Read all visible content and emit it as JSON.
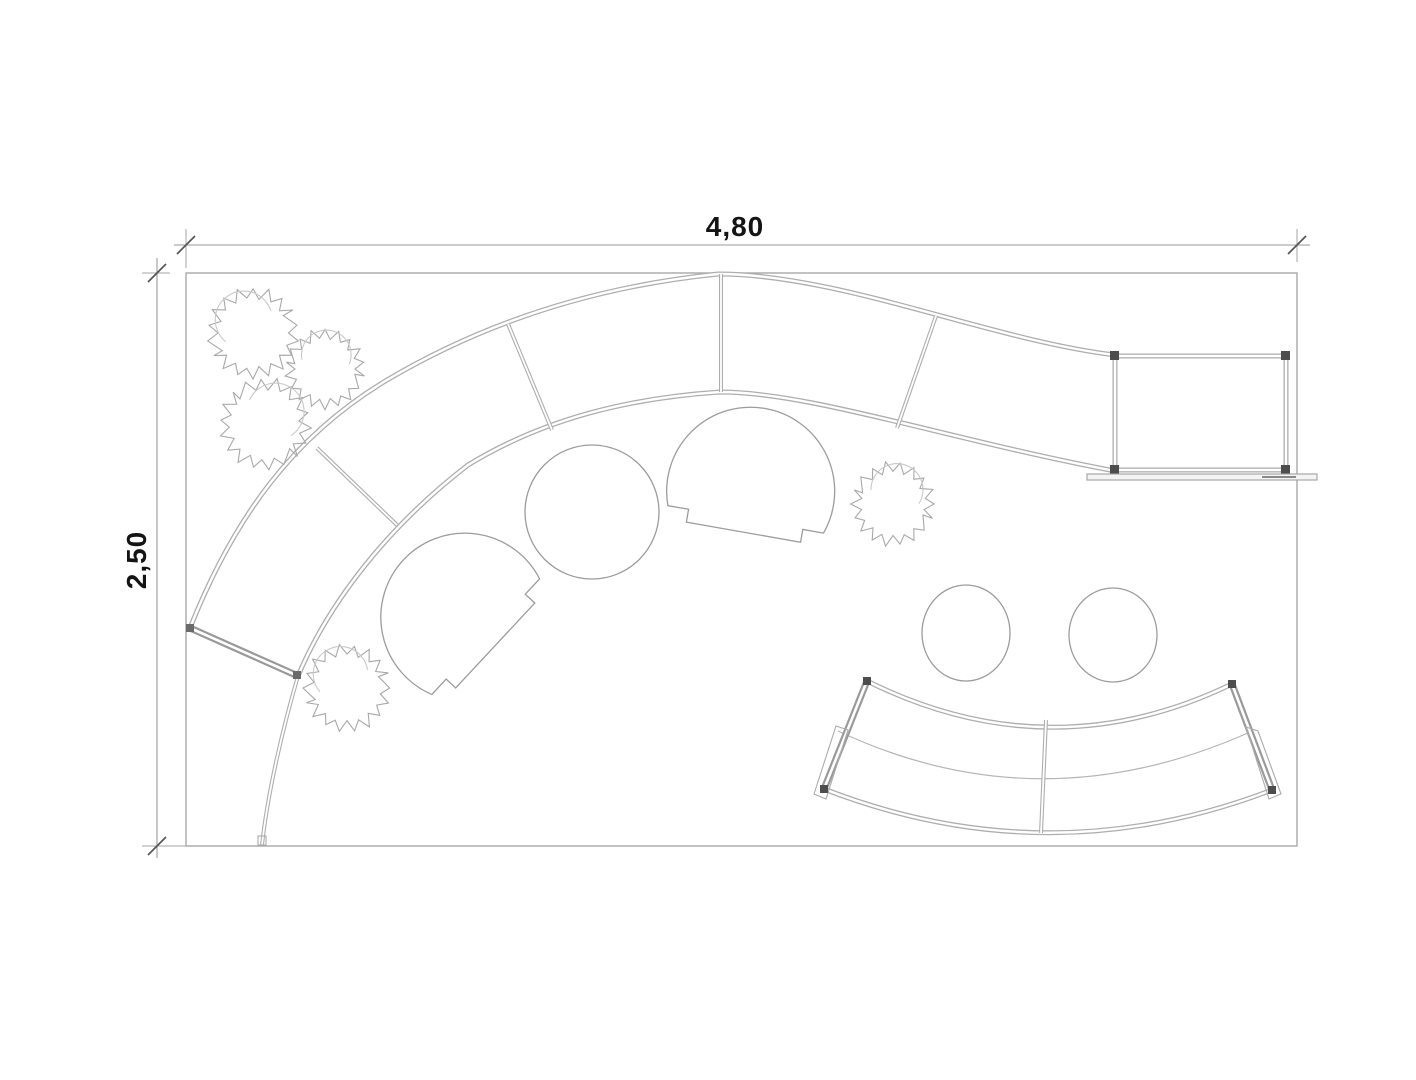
{
  "page": {
    "type": "booth-floor-plan",
    "background": "#ffffff"
  },
  "dimensions": {
    "width_label": "4,80",
    "height_label": "2,50"
  },
  "colors": {
    "wall_line": "#aeaeae",
    "furniture_line": "#9c9c9c",
    "plant_line": "#a8a8a8",
    "dimension_line": "#9a9a9a",
    "dimension_text": "#141414",
    "corner_post": "#4d4d4d"
  },
  "furniture": {
    "plants": 5,
    "armchairs": 2,
    "round_tables": 1,
    "stools": 2,
    "curved_wall_segments": 5,
    "cabin_rooms": 1,
    "counter_segments": 2
  }
}
